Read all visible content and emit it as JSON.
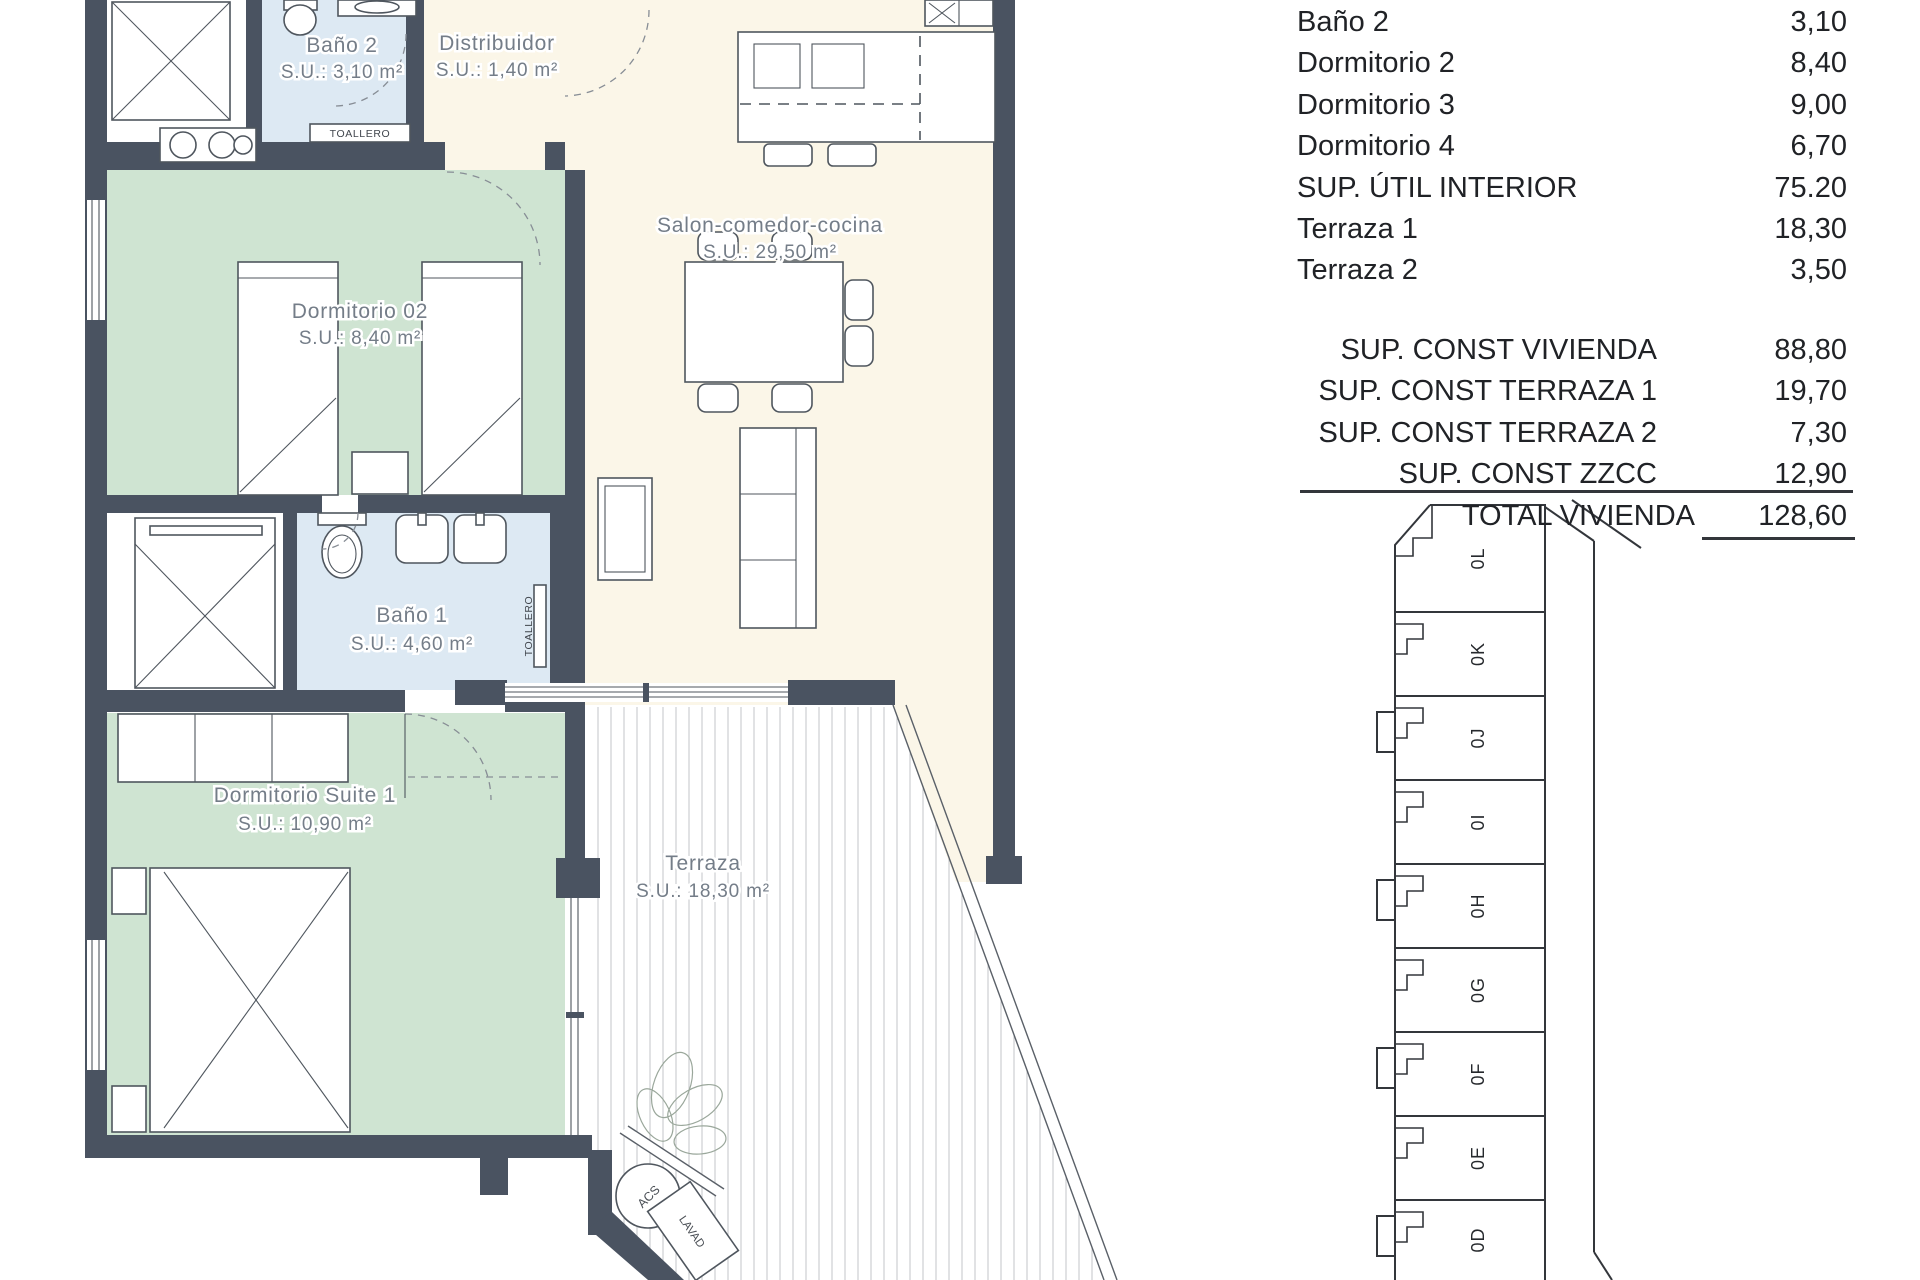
{
  "plan": {
    "rooms": {
      "bano2": {
        "name": "Baño 2",
        "area": "S.U.: 3,10 m²"
      },
      "distribuidor": {
        "name": "Distribuidor",
        "area": "S.U.: 1,40 m²"
      },
      "salon": {
        "name": "Salon-comedor-cocina",
        "area": "S.U.: 29,50 m²"
      },
      "dormitorio02": {
        "name": "Dormitorio 02",
        "area": "S.U.: 8,40 m²"
      },
      "bano1": {
        "name": "Baño 1",
        "area": "S.U.: 4,60 m²"
      },
      "suite": {
        "name": "Dormitorio Suite 1",
        "area": "S.U.: 10,90 m²"
      },
      "terraza": {
        "name": "Terraza",
        "area": "S.U.: 18,30 m²"
      }
    },
    "fixtures": {
      "toallero_bano2": "TOALLERO",
      "toallero_bano1": "TOALLERO",
      "acs": "ACS",
      "lavadero": "LAVAD"
    }
  },
  "areas_table": {
    "rows": [
      {
        "label": "Baño 2",
        "value": "3,10"
      },
      {
        "label": "Dormitorio 2",
        "value": "8,40"
      },
      {
        "label": "Dormitorio 3",
        "value": "9,00"
      },
      {
        "label": "Dormitorio 4",
        "value": "6,70"
      },
      {
        "label": "SUP. ÚTIL INTERIOR",
        "value": "75.20"
      },
      {
        "label": "Terraza 1",
        "value": "18,30"
      },
      {
        "label": "Terraza 2",
        "value": "3,50"
      }
    ],
    "totals": [
      {
        "label": "SUP. CONST VIVIENDA",
        "value": "88,80"
      },
      {
        "label": "SUP. CONST TERRAZA 1",
        "value": "19,70"
      },
      {
        "label": "SUP. CONST TERRAZA 2",
        "value": "7,30"
      },
      {
        "label": "SUP. CONST ZZCC",
        "value": "12,90"
      }
    ],
    "grand_total": {
      "label": "TOTAL VIVIENDA",
      "value": "128,60"
    }
  },
  "key_plan": {
    "units": [
      "0L",
      "0K",
      "0J",
      "0I",
      "0H",
      "0G",
      "0F",
      "0E",
      "0D"
    ]
  },
  "colors": {
    "wall": "#4a5361",
    "floor_living": "#fbf6e8",
    "floor_bedroom": "#cfe4d2",
    "floor_bath": "#dde9f3",
    "line": "#4f565e",
    "label": "#747d88",
    "ink": "#202226"
  }
}
